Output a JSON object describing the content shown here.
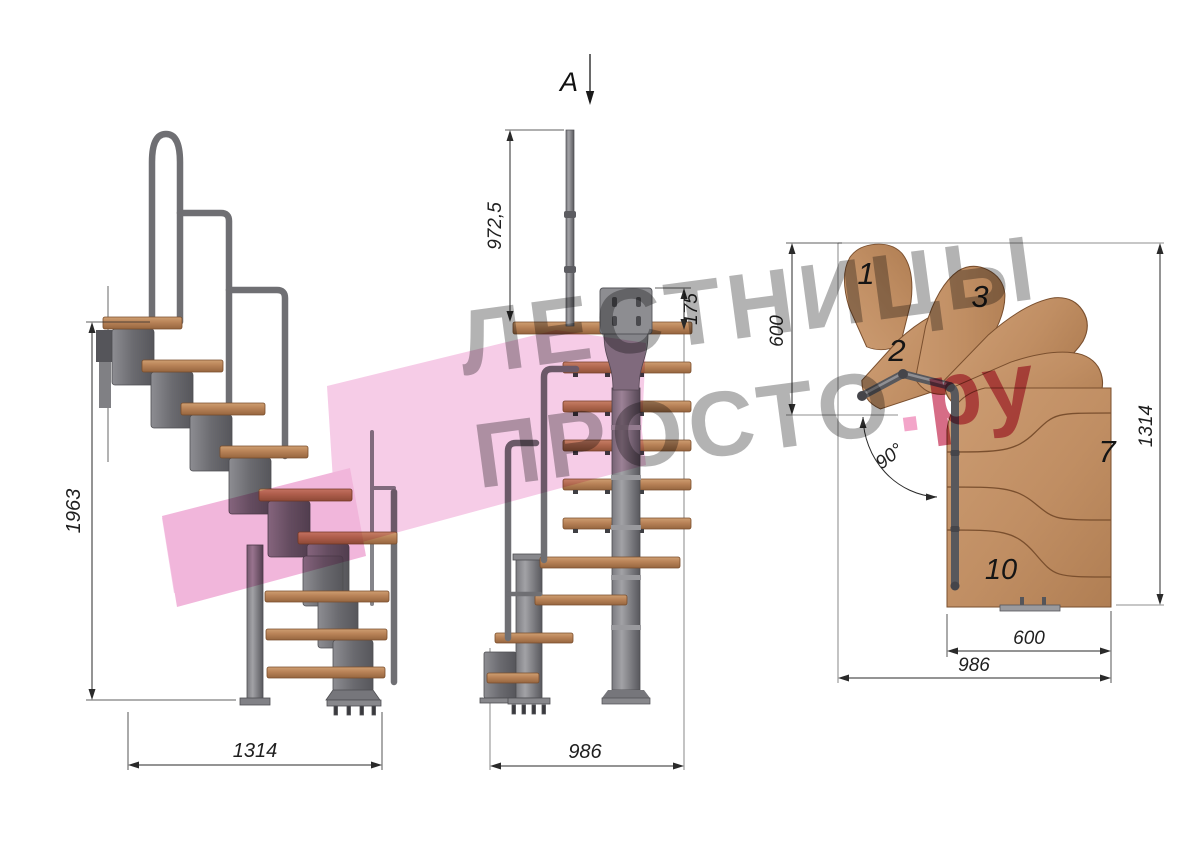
{
  "watermark": {
    "line1": "ЛЕСТНИЦЫ",
    "line2": "ПРОСТО",
    "dot": ".",
    "suffix": "ру"
  },
  "section_cut": {
    "label": "A"
  },
  "side_view": {
    "total_height": "1963",
    "total_length": "1314"
  },
  "front_view": {
    "handrail_height": "972,5",
    "mount_plate_height": "175",
    "total_depth": "986"
  },
  "plan_view": {
    "entry_width": "600",
    "total_length": "1314",
    "flight_width": "600",
    "total_width": "986",
    "turn_angle": "90°",
    "step_labels": {
      "step1": "1",
      "step2": "2",
      "step3": "3",
      "step7": "7",
      "step10": "10"
    }
  },
  "palette": {
    "wood": "#bf8a5f",
    "wood_dark": "#7a4f2e",
    "metal": "#77777b",
    "metal_dark": "#55555a",
    "dimension_line": "#2a2a2a",
    "logo_pink": "#f5c3e3",
    "logo_pink_dark": "#efa9d5",
    "watermark_gray": "#b0b0b0",
    "watermark_dot_pink": "#f2a0c6",
    "watermark_text_pink": "#d4647f"
  }
}
